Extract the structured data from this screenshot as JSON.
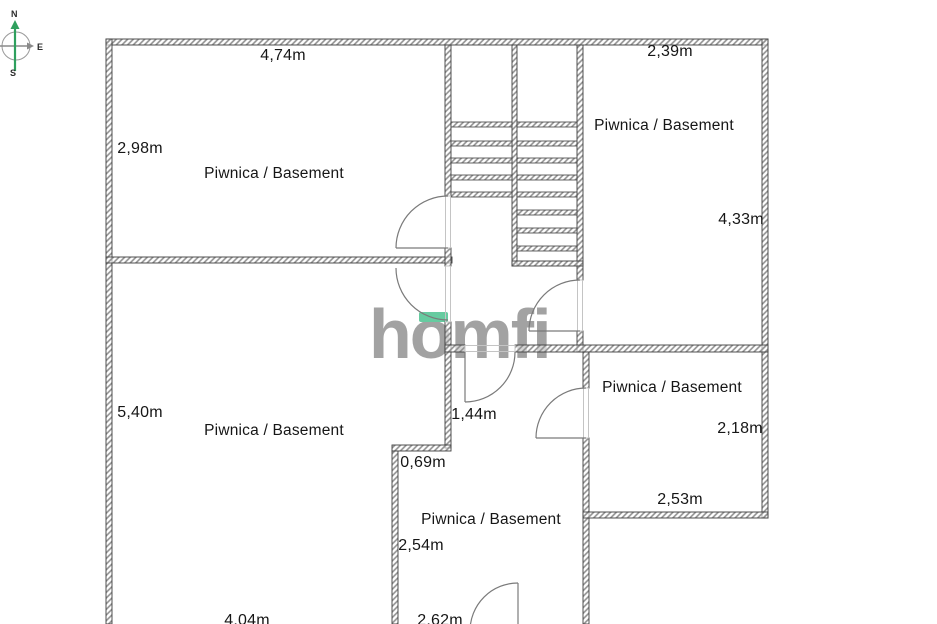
{
  "title": "Piwnica / Basement floor plan",
  "compass": {
    "north": "N",
    "east": "E",
    "south": "S",
    "axis_color": "#2fa05e"
  },
  "logo": {
    "text": "homfi",
    "color": "#9b9b9b",
    "accent_color": "#66cba0"
  },
  "colors": {
    "wall_line": "#3f3f3f",
    "wall_hatch": "#8f8f8f",
    "door_line": "#7a7a7a",
    "text": "#161616",
    "background": "#ffffff"
  },
  "rooms": {
    "top_left": {
      "name": "Piwnica / Basement",
      "width": "4,74m",
      "height": "2,98m"
    },
    "top_right": {
      "name": "Piwnica / Basement",
      "width": "2,39m",
      "height": "4,33m"
    },
    "left": {
      "name": "Piwnica / Basement",
      "height": "5,40m",
      "width": "4,04m"
    },
    "middle_right": {
      "name": "Piwnica / Basement",
      "height": "2,18m",
      "width": "2,53m"
    },
    "bottom_middle": {
      "name": "Piwnica / Basement",
      "height": "2,54m",
      "width": "2,62m"
    },
    "hallway": {
      "width": "1,44m"
    },
    "notch": {
      "width": "0,69m"
    }
  }
}
